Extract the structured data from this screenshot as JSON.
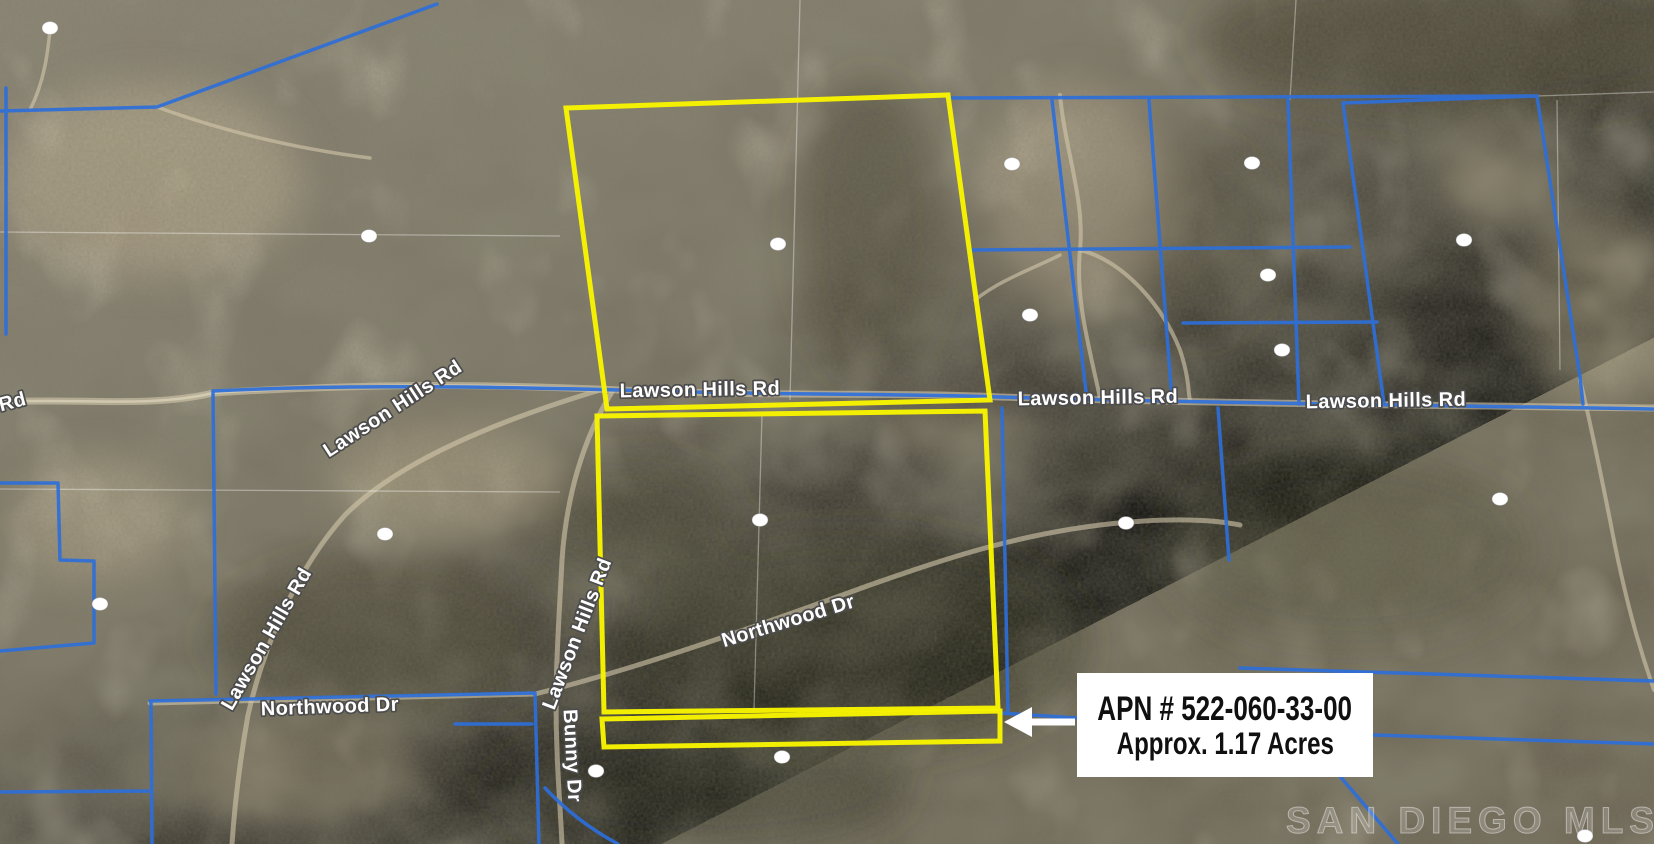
{
  "callout": {
    "line1": "APN # 522-060-33-00",
    "line2": "Approx. 1.17 Acres"
  },
  "watermark": "SAN DIEGO MLS",
  "map": {
    "road_labels": [
      {
        "text": "Lawson Hills Rd",
        "x": 700,
        "y": 396,
        "rot": -1
      },
      {
        "text": "Lawson Hills Rd",
        "x": 1098,
        "y": 404,
        "rot": -1
      },
      {
        "text": "Lawson Hills Rd",
        "x": 1386,
        "y": 407,
        "rot": -1
      },
      {
        "text": "Lawson Hills Rd",
        "x": 396,
        "y": 414,
        "rot": -33
      },
      {
        "text": "Lawson Hills Rd",
        "x": 272,
        "y": 642,
        "rot": -60
      },
      {
        "text": "Lawson Hills Rd",
        "x": 583,
        "y": 636,
        "rot": -69
      },
      {
        "text": "Northwood Dr",
        "x": 790,
        "y": 627,
        "rot": -17
      },
      {
        "text": "Northwood Dr",
        "x": 330,
        "y": 713,
        "rot": -2
      },
      {
        "text": "Bunny Dr",
        "x": 566,
        "y": 756,
        "rot": 87
      },
      {
        "text": "Rd",
        "x": 14,
        "y": 408,
        "rot": -15
      }
    ],
    "markers": [
      [
        50,
        28
      ],
      [
        369,
        236
      ],
      [
        778,
        244
      ],
      [
        1012,
        164
      ],
      [
        1030,
        315
      ],
      [
        1252,
        163
      ],
      [
        1268,
        275
      ],
      [
        1282,
        350
      ],
      [
        1464,
        240
      ],
      [
        385,
        534
      ],
      [
        760,
        520
      ],
      [
        1126,
        523
      ],
      [
        1500,
        499
      ],
      [
        100,
        604
      ],
      [
        596,
        771
      ],
      [
        782,
        757
      ],
      [
        1585,
        836
      ]
    ],
    "colors": {
      "boundary": "#2e6fd9",
      "highlight": "#f8f400",
      "highlight_fill": "rgba(248,244,0,0.45)",
      "marker": "#ffffff",
      "callout_bg": "#ffffff",
      "callout_text": "#101010"
    }
  }
}
